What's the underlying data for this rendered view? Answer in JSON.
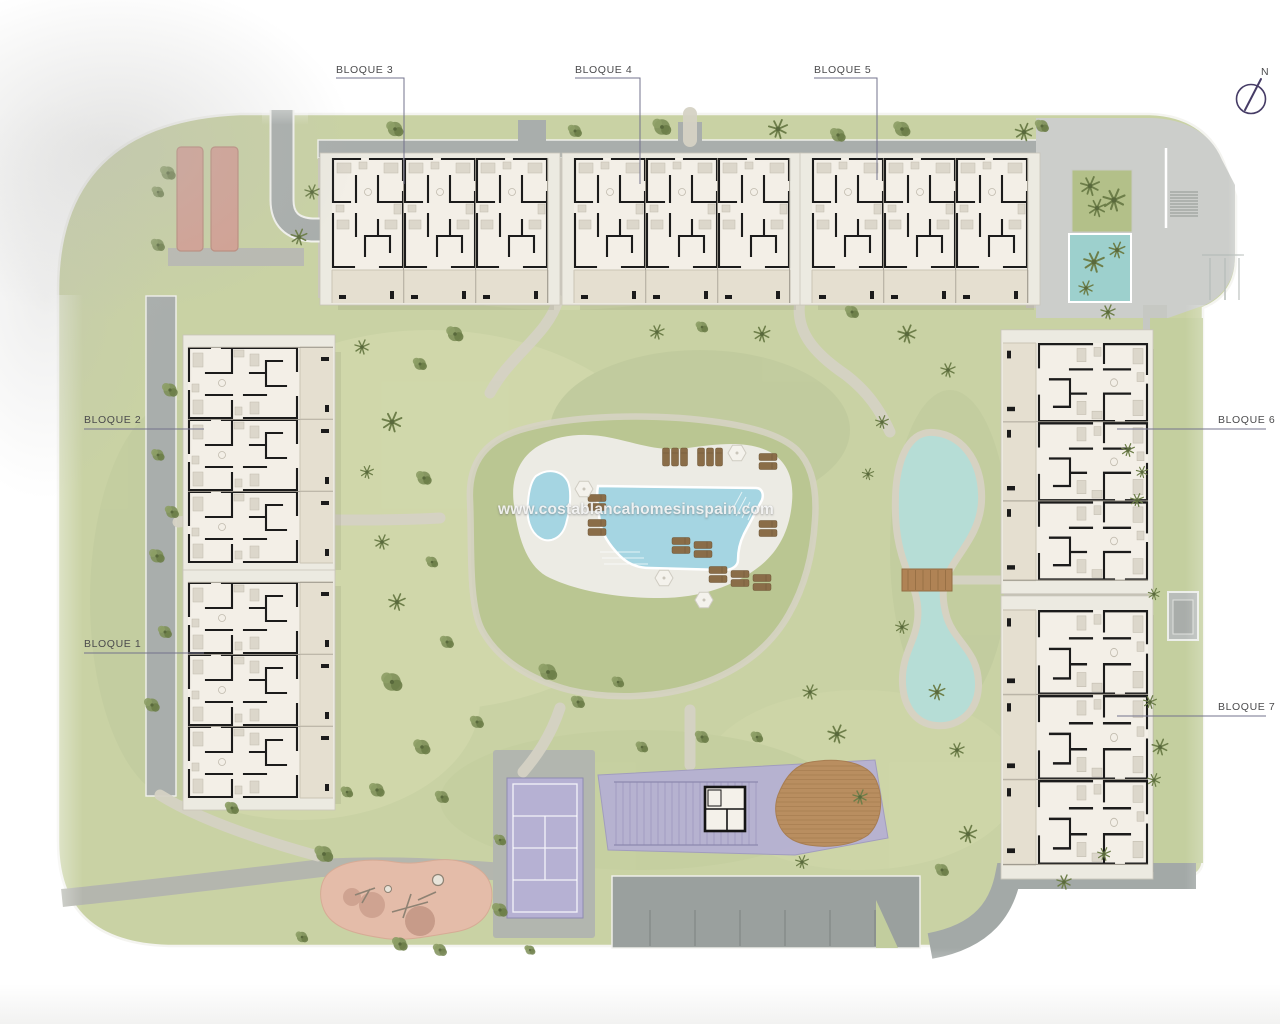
{
  "watermark": {
    "text": "www.costablancahomesinspain.com"
  },
  "compass": {
    "label": "N"
  },
  "labels": {
    "bloque_1": "BLOQUE 1",
    "bloque_2": "BLOQUE 2",
    "bloque_3": "BLOQUE 3",
    "bloque_4": "BLOQUE 4",
    "bloque_5": "BLOQUE 5",
    "bloque_6": "BLOQUE 6",
    "bloque_7": "BLOQUE 7"
  },
  "colors": {
    "lawn": "#c9d2a4",
    "mound": "#bac692",
    "pool_deck": "#ecebe4",
    "pool_water": "#a5d5e2",
    "lake_water": "#b6ddd6",
    "lake_shore": "#d6d2c2",
    "road": "#a9aeac",
    "path": "#d5d2c4",
    "plaza": "#cccecb",
    "parking_lot": "#9aa09e",
    "court_purple": "#b6b1d3",
    "petanque": "#d3a092",
    "playground": "#e4bca9",
    "wood_deck": "#b98e60",
    "spa_pool": "#9dd0cd",
    "building_floor": "#f3efe7",
    "terrace": "#e5dfd0"
  }
}
